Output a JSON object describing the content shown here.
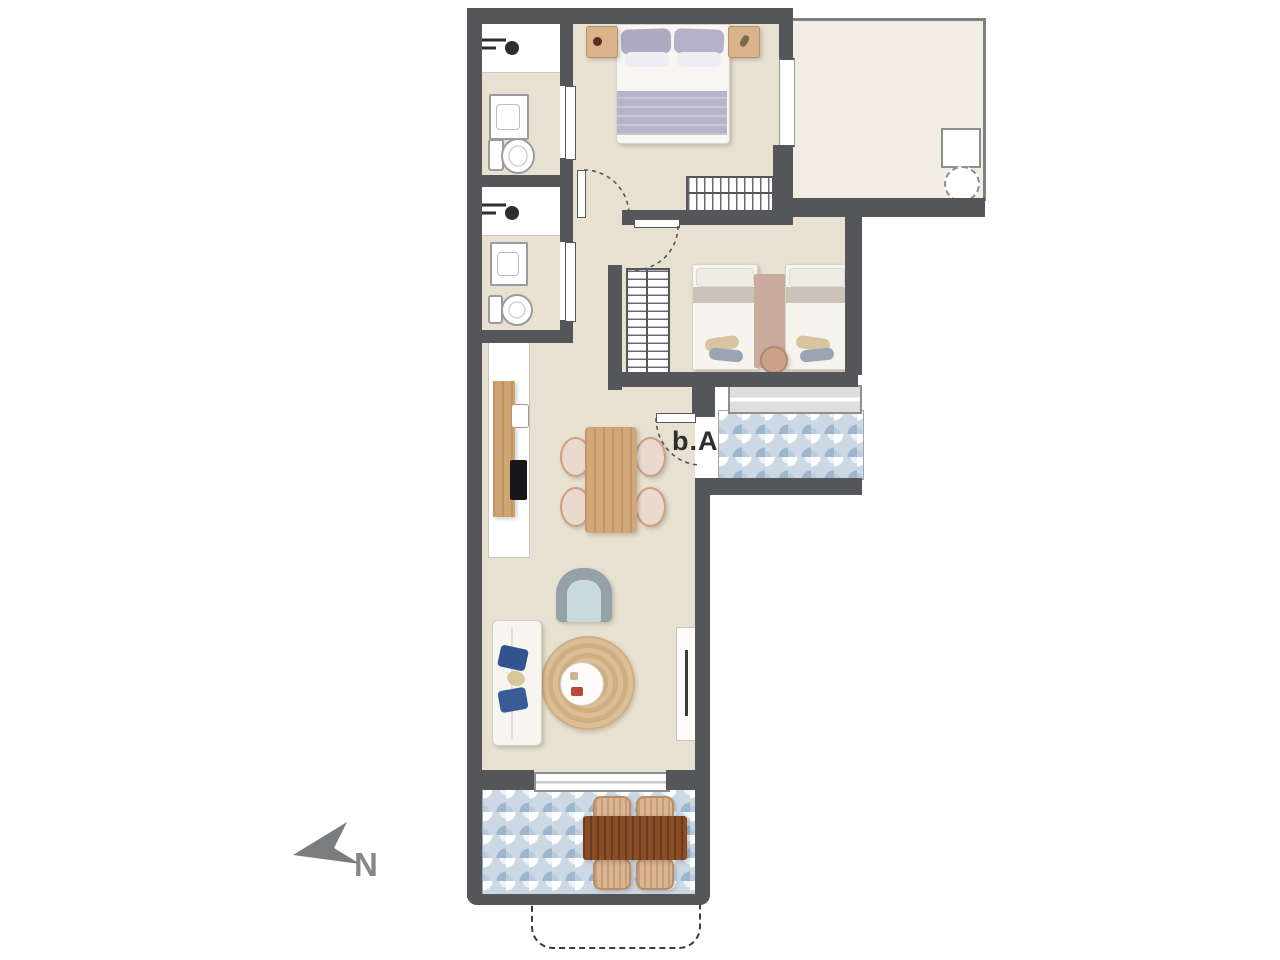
{
  "labels": {
    "entrance_door": "b.A",
    "compass_north": "N"
  },
  "colors": {
    "wall": "#55565a",
    "floor": "#e8e1d1",
    "terrace_floor": "#f1ede3",
    "tile_base": "#ccd8e3",
    "tile_blue": "#9db6cd",
    "wood": "#d2a87a",
    "wood_dark": "#8a4d28",
    "rug": "#d7b78e",
    "blanket_lavender": "#b7b3c8",
    "pillow_blue": "#32538e",
    "bed_blanket_beige": "#decdc3",
    "label_text": "#2e2e2e",
    "north_text": "#87878a"
  }
}
